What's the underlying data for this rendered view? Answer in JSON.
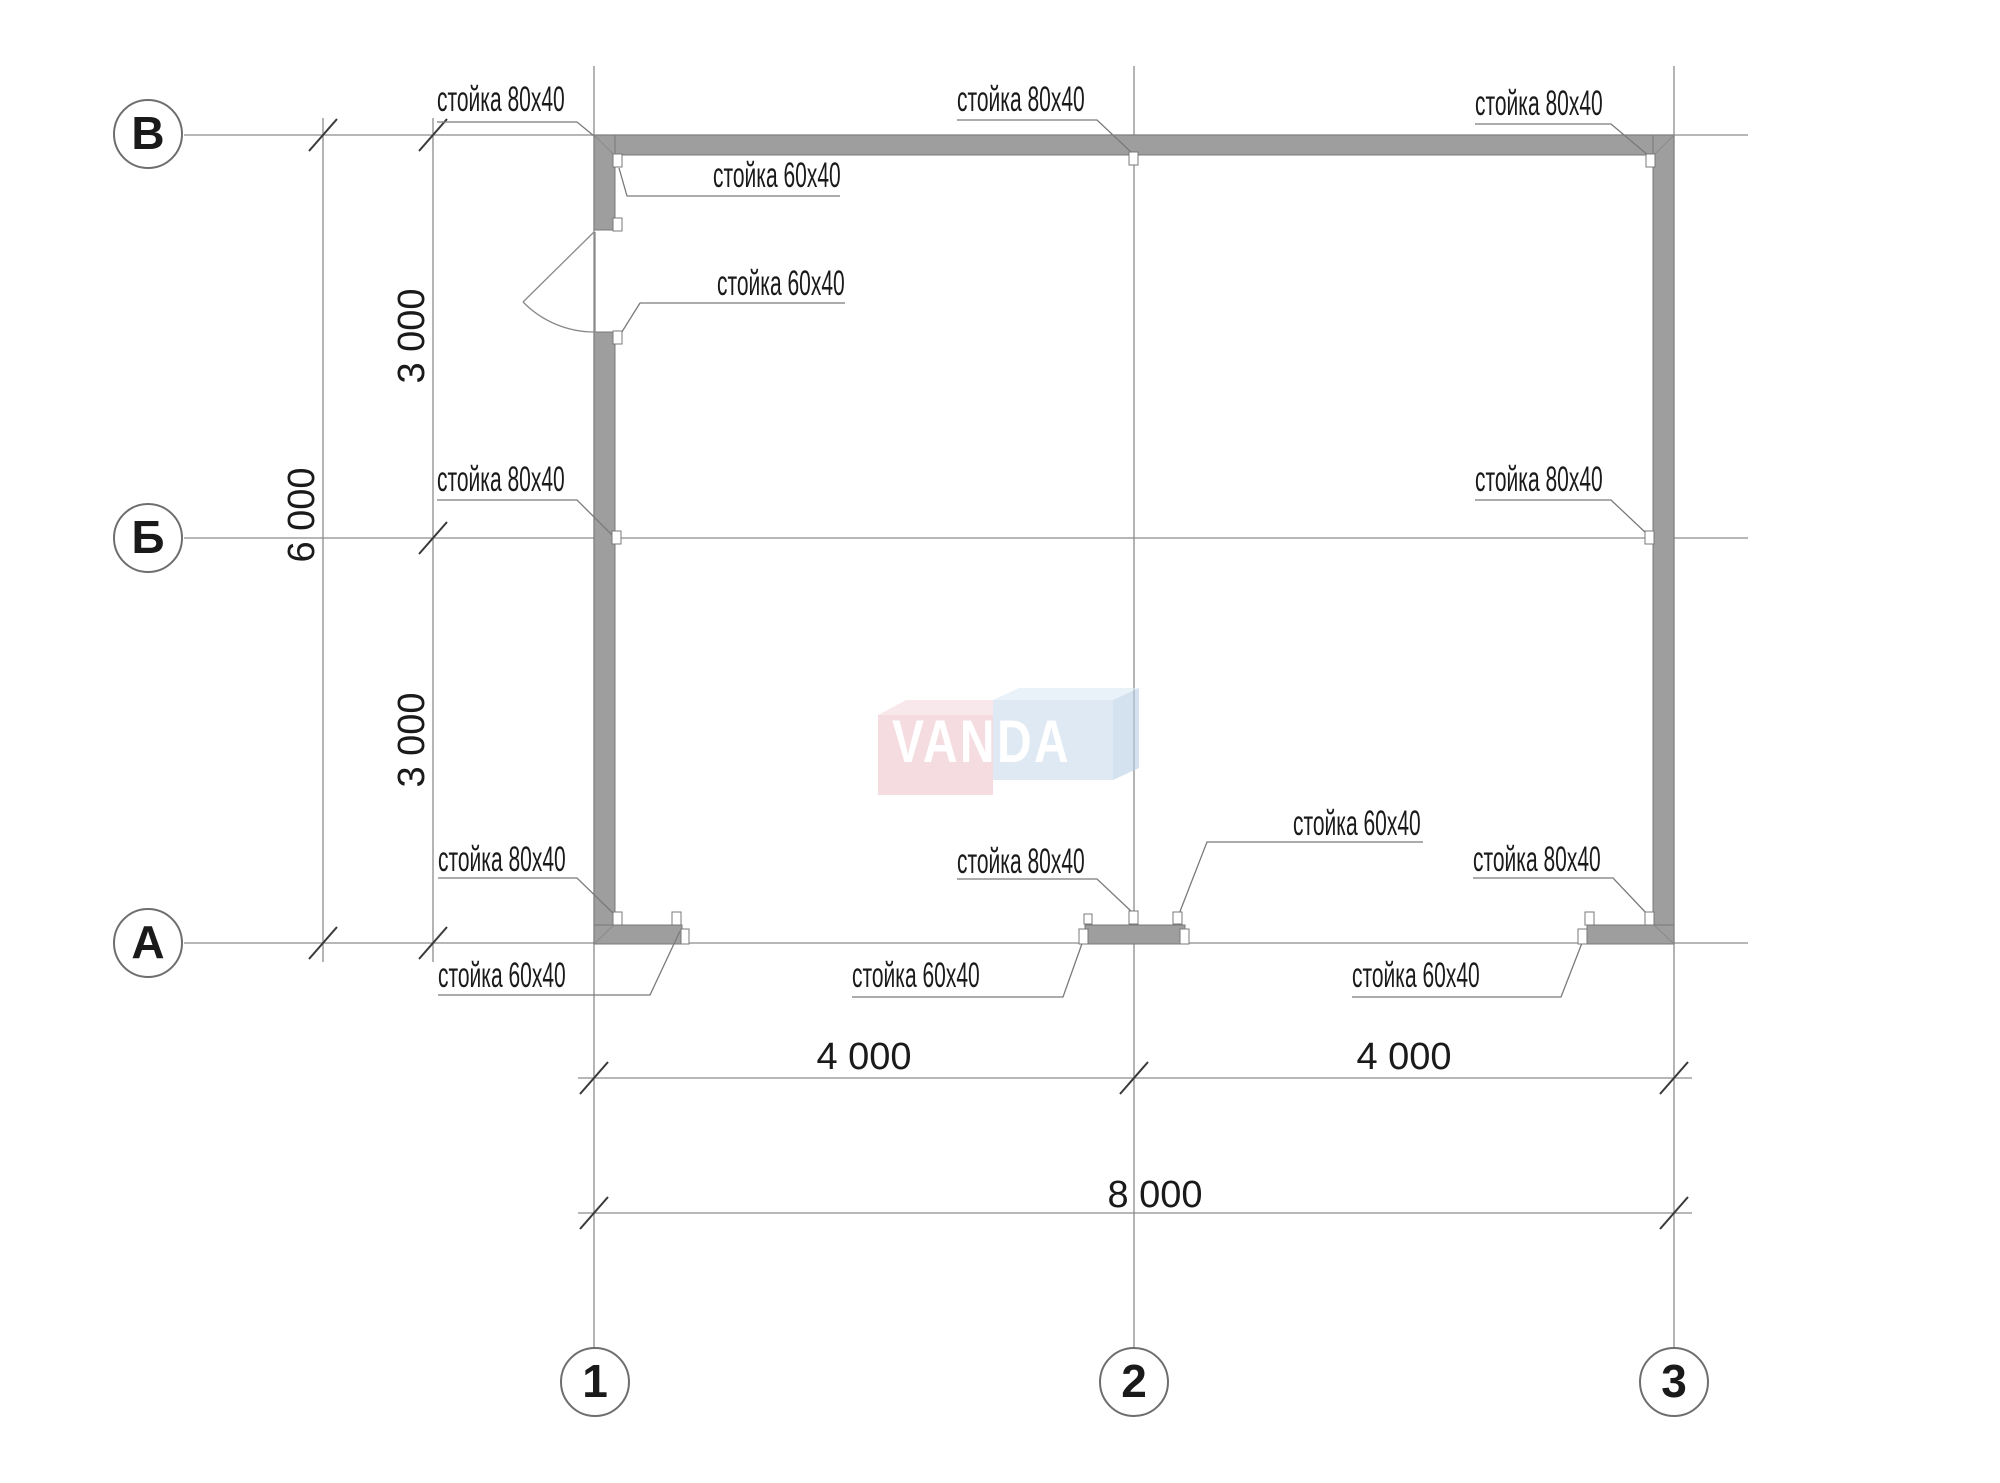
{
  "drawing": {
    "type": "frame-building floor plan",
    "watermark": "VANDA"
  },
  "axis_bubbles": {
    "rows": [
      {
        "label": "В"
      },
      {
        "label": "Б"
      },
      {
        "label": "А"
      }
    ],
    "cols": [
      {
        "label": "1"
      },
      {
        "label": "2"
      },
      {
        "label": "3"
      }
    ]
  },
  "dimensions": {
    "col_span_left": "4 000",
    "col_span_right": "4 000",
    "col_total": "8 000",
    "row_span_top": "3 000",
    "row_span_bottom": "3 000",
    "row_total": "6 000"
  },
  "stud_labels": [
    {
      "text": "стойка 80х40"
    },
    {
      "text": "стойка 80х40"
    },
    {
      "text": "стойка 80х40"
    },
    {
      "text": "стойка 60х40"
    },
    {
      "text": "стойка 60х40"
    },
    {
      "text": "стойка 80х40"
    },
    {
      "text": "стойка 80х40"
    },
    {
      "text": "стойка 80х40"
    },
    {
      "text": "стойка 80х40"
    },
    {
      "text": "стойка 60х40"
    },
    {
      "text": "стойка 80х40"
    },
    {
      "text": "стойка 60х40"
    },
    {
      "text": "стойка 60х40"
    },
    {
      "text": "стойка 60х40"
    }
  ],
  "logo": {
    "text": "VANDA"
  },
  "colors": {
    "wall_fill": "#9e9e9e",
    "wall_edge": "#787878",
    "thin_line": "#8c8c8c",
    "tick": "#3a3a3a",
    "logo_pink": "#eec6cd",
    "logo_blue": "#c9dbee"
  }
}
